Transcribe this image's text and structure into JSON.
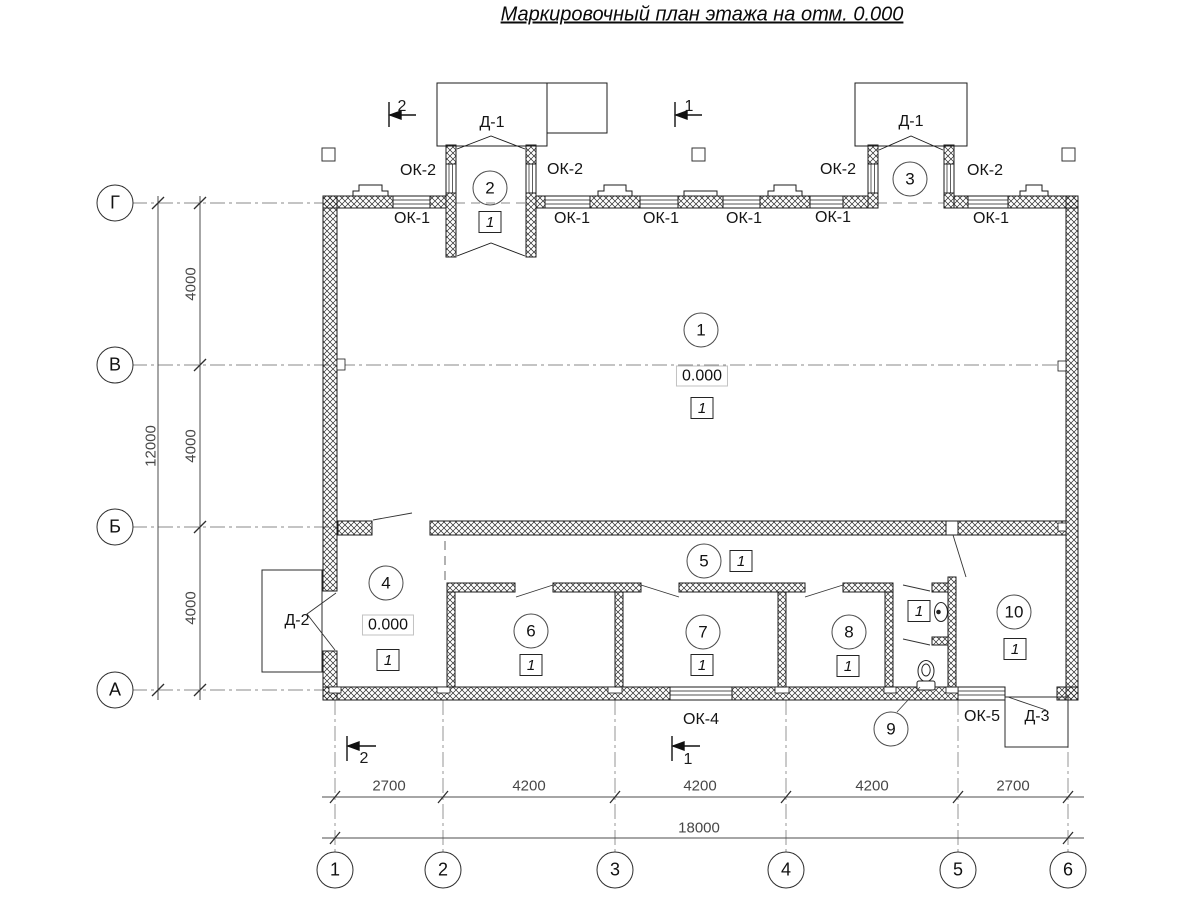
{
  "title": "Маркировочный план этажа на отм. 0.000",
  "axes": {
    "rows": [
      "Г",
      "В",
      "Б",
      "А"
    ],
    "cols": [
      "1",
      "2",
      "3",
      "4",
      "5",
      "6"
    ]
  },
  "dims": {
    "left": [
      "4000",
      "4000",
      "4000"
    ],
    "left_total": "12000",
    "bottom": [
      "2700",
      "4200",
      "4200",
      "4200",
      "2700"
    ],
    "bottom_total": "18000"
  },
  "rooms": [
    "1",
    "2",
    "3",
    "4",
    "5",
    "6",
    "7",
    "8",
    "9",
    "10"
  ],
  "marks": {
    "elevation": "0.000",
    "floor_type": "1"
  },
  "labels": {
    "ok1": "ОК-1",
    "ok2": "ОК-2",
    "ok4": "ОК-4",
    "ok5": "ОК-5",
    "d1": "Д-1",
    "d2": "Д-2",
    "d3": "Д-3"
  },
  "sections": {
    "cut1": "1",
    "cut2": "2"
  }
}
